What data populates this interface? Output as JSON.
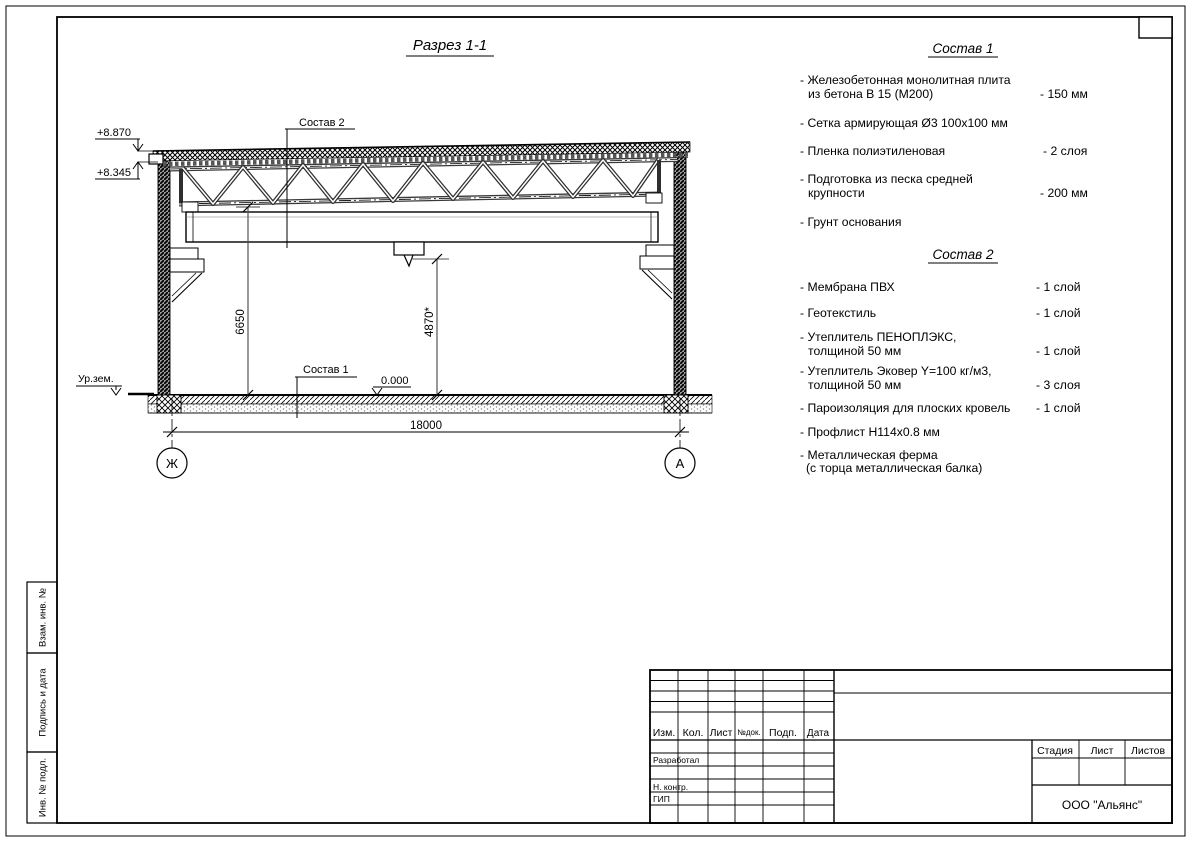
{
  "drawing": {
    "title": "Разрез 1-1",
    "labels": {
      "sostav2": "Состав 2",
      "sostav1": "Состав 1",
      "elev_roof_top": "+8.870",
      "elev_roof_bottom": "+8.345",
      "ground_level": "Ур.зем.",
      "zero_level": "0.000",
      "dim_height": "6650",
      "dim_hook": "4870*",
      "dim_span": "18000",
      "axis_left": "Ж",
      "axis_right": "А"
    }
  },
  "sostav1": {
    "title": "Состав 1",
    "items": [
      {
        "line1": "- Железобетонная  монолитная плита",
        "line2": "из бетона В 15 (М200)",
        "value": "- 150 мм"
      },
      {
        "line1": "- Сетка армирующая Ø3 100х100 мм",
        "line2": "",
        "value": ""
      },
      {
        "line1": "- Пленка полиэтиленовая",
        "line2": "",
        "value": "- 2 слоя"
      },
      {
        "line1": "- Подготовка из песка средней",
        "line2": "крупности",
        "value": "- 200 мм"
      },
      {
        "line1": "- Грунт основания",
        "line2": "",
        "value": ""
      }
    ]
  },
  "sostav2": {
    "title": "Состав 2",
    "items": [
      {
        "line1": "- Мембрана ПВХ",
        "line2": "",
        "value": "- 1 слой"
      },
      {
        "line1": "- Геотекстиль",
        "line2": "",
        "value": "- 1 слой"
      },
      {
        "line1": "- Утеплитель ПЕНОПЛЭКС,",
        "line2": "толщиной 50 мм",
        "value": "- 1 слой"
      },
      {
        "line1": "- Утеплитель Эковер Y=100 кг/м3,",
        "line2": "толщиной 50 мм",
        "value": "- 3 слоя"
      },
      {
        "line1": "- Пароизоляция для плоских кровель",
        "line2": "",
        "value": "- 1 слой"
      },
      {
        "line1": "- Профлист Н114х0.8 мм",
        "line2": "",
        "value": ""
      },
      {
        "line1": "- Металлическая ферма",
        "line2": "(с торца металлическая балка)",
        "value": ""
      }
    ]
  },
  "titleblock": {
    "col_izm": "Изм.",
    "col_kol": "Кол.",
    "col_list": "Лист",
    "col_ndok": "№док.",
    "col_podp": "Подп.",
    "col_data": "Дата",
    "row_razrabotal": "Разработал",
    "row_nkontr": "Н. контр.",
    "row_gip": "ГИП",
    "stage": "Стадия",
    "sheet": "Лист",
    "sheets": "Листов",
    "company": "ООО \"Альянс\""
  },
  "sidebar": {
    "cell1": "Взам. инв. №",
    "cell2": "Подпись и дата",
    "cell3": "Инв. № подл."
  }
}
